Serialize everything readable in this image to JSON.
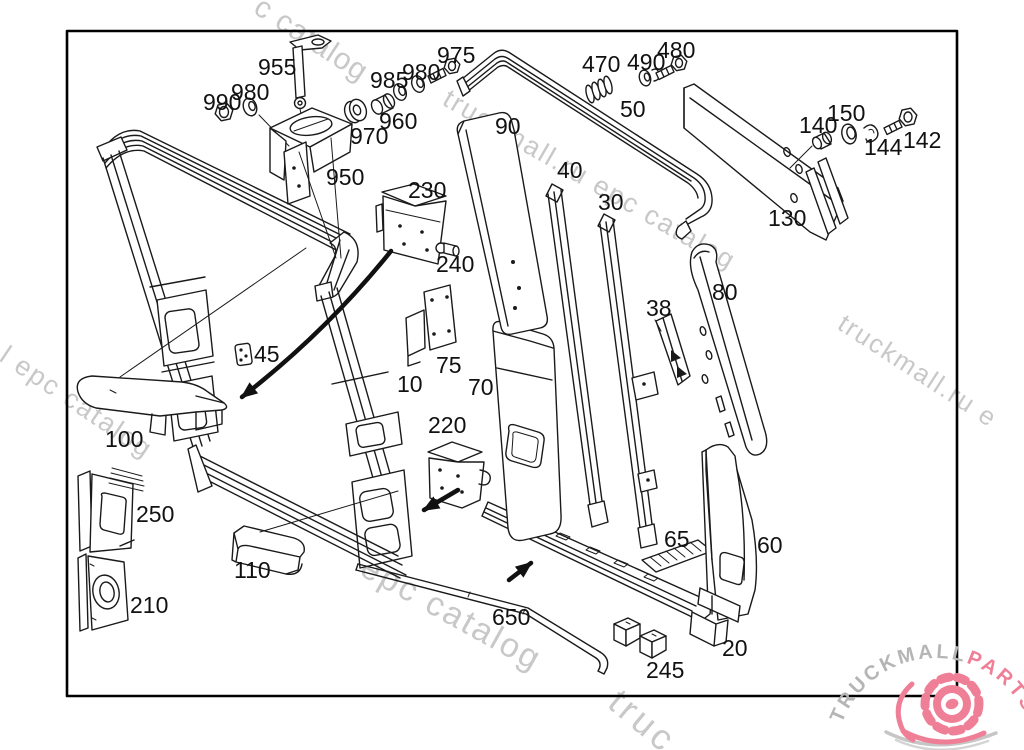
{
  "diagram": {
    "background": "#ffffff",
    "line_color": "#1a1a1a",
    "border_color": "#000000",
    "watermark_color": "#c8c8c8"
  },
  "watermarks": {
    "w1": "c catalog",
    "w2": "truckmall.ru epc catalog",
    "w3": "l epc catalog",
    "w4": "truckmall.ru e",
    "w5": "epc catalog",
    "w6": "truc"
  },
  "logo": {
    "part1": "TRUCKMALL",
    "part2": "PARTS",
    "gray": "#b5b5b5",
    "pink": "#ef7f96"
  },
  "labels": {
    "p955": "955",
    "p990": "990",
    "p980a": "980",
    "p985": "985",
    "p980b": "980",
    "p975": "975",
    "p960": "960",
    "p970": "970",
    "p950": "950",
    "p230": "230",
    "p240": "240",
    "p90": "90",
    "p40": "40",
    "p30": "30",
    "p50": "50",
    "p470": "470",
    "p490": "490",
    "p480": "480",
    "p140": "140",
    "p150": "150",
    "p144": "144",
    "p142": "142",
    "p130": "130",
    "p80": "80",
    "p38": "38",
    "p45": "45",
    "p75": "75",
    "p10": "10",
    "p70": "70",
    "p220": "220",
    "p100": "100",
    "p250": "250",
    "p210": "210",
    "p110": "110",
    "p650": "650",
    "p245": "245",
    "p20": "20",
    "p65": "65",
    "p60": "60"
  }
}
